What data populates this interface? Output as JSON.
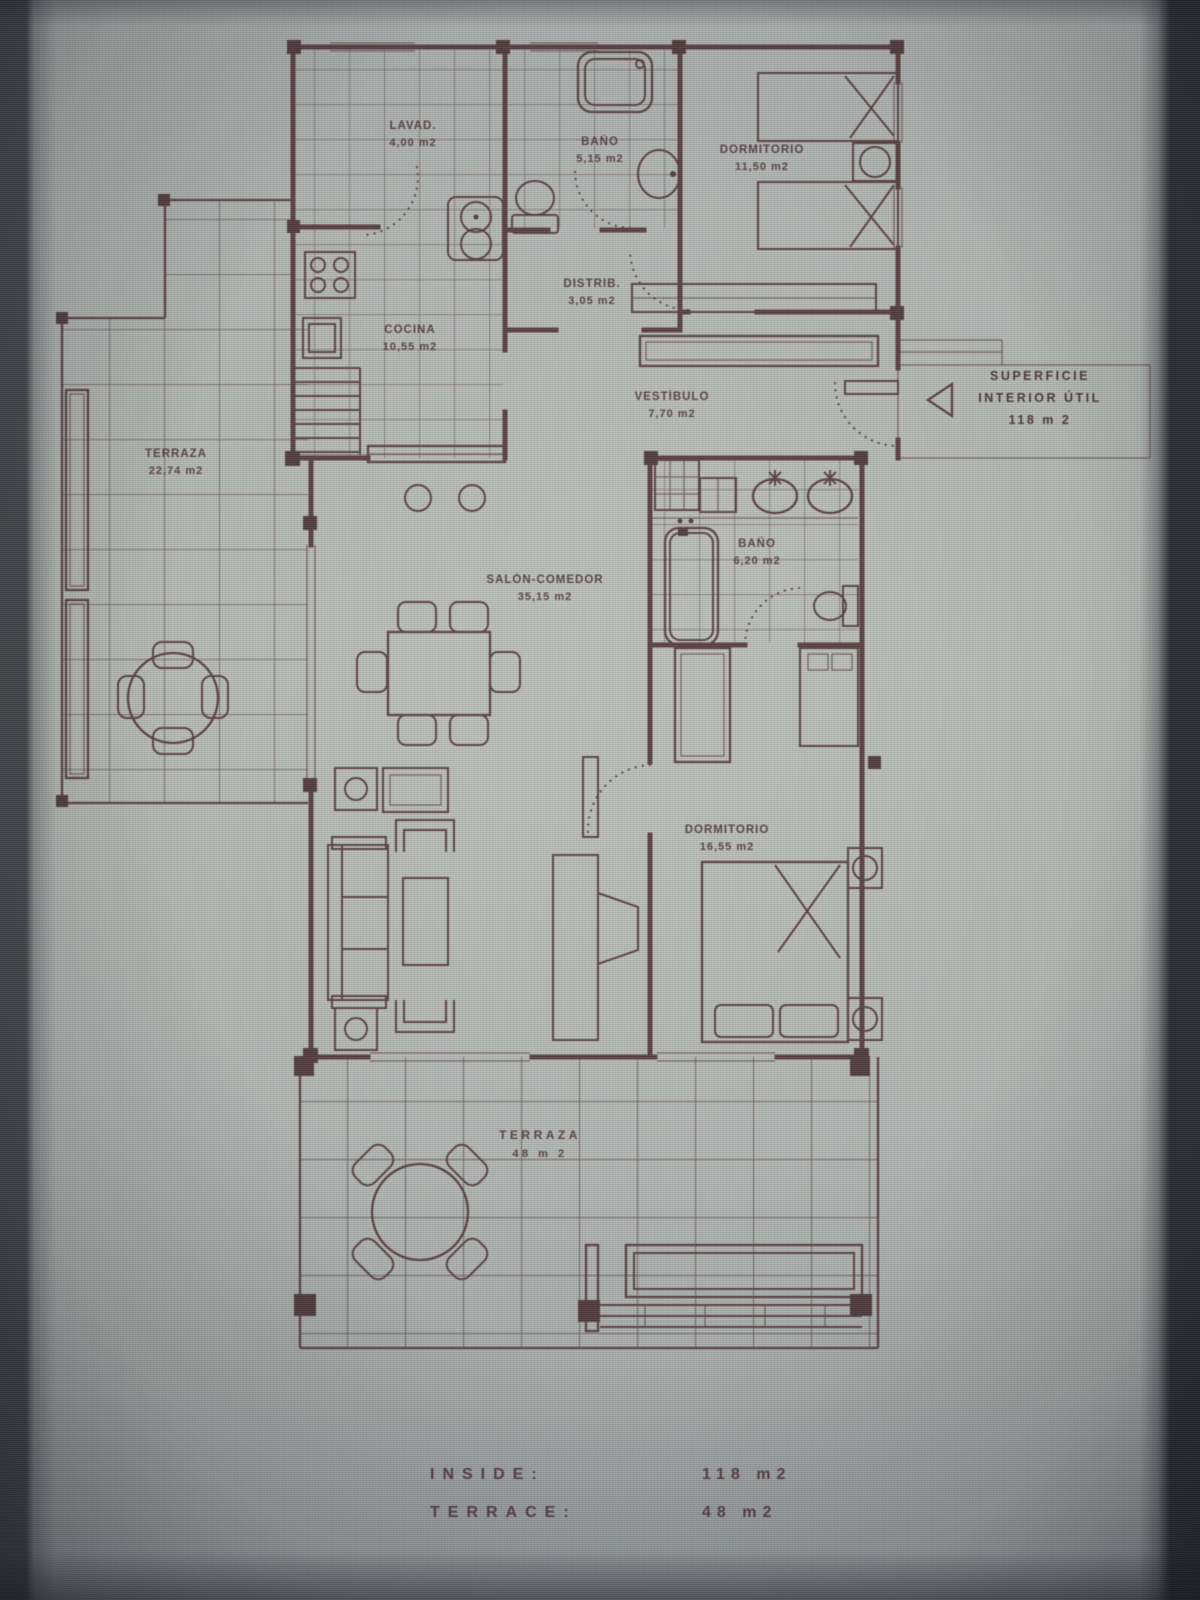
{
  "photo": {
    "description": "Photographed architectural floor plan on a screen",
    "line_color": "#4b2a2e",
    "paper_color": "#b4b8b2"
  },
  "rooms": {
    "lavadero": {
      "name": "LAVAD.",
      "area": "4,00 m2"
    },
    "bano1": {
      "name": "BAÑO",
      "area": "5,15 m2"
    },
    "dormitorio1": {
      "name": "DORMITORIO",
      "area": "11,50 m2"
    },
    "distribuidor": {
      "name": "DISTRIB.",
      "area": "3,05 m2"
    },
    "cocina": {
      "name": "COCINA",
      "area": "10,55 m2"
    },
    "vestibulo": {
      "name": "VESTÍBULO",
      "area": "7,70 m2"
    },
    "terraza1": {
      "name": "TERRAZA",
      "area": "22,74 m2"
    },
    "salon": {
      "name": "SALÓN-COMEDOR",
      "area": "35,15 m2"
    },
    "bano2": {
      "name": "BAÑO",
      "area": "6,20 m2"
    },
    "dormitorio2": {
      "name": "DORMITORIO",
      "area": "16,55 m2"
    },
    "terraza2": {
      "name": "TERRAZA",
      "area": "48 m 2"
    }
  },
  "annotation": {
    "line1": "SUPERFICIE",
    "line2": "INTERIOR ÚTIL",
    "line3": "118 m 2"
  },
  "summary": {
    "rows": [
      {
        "label": "INSIDE:",
        "value": "118 m2"
      },
      {
        "label": "TERRACE:",
        "value": "48 m2"
      }
    ]
  }
}
